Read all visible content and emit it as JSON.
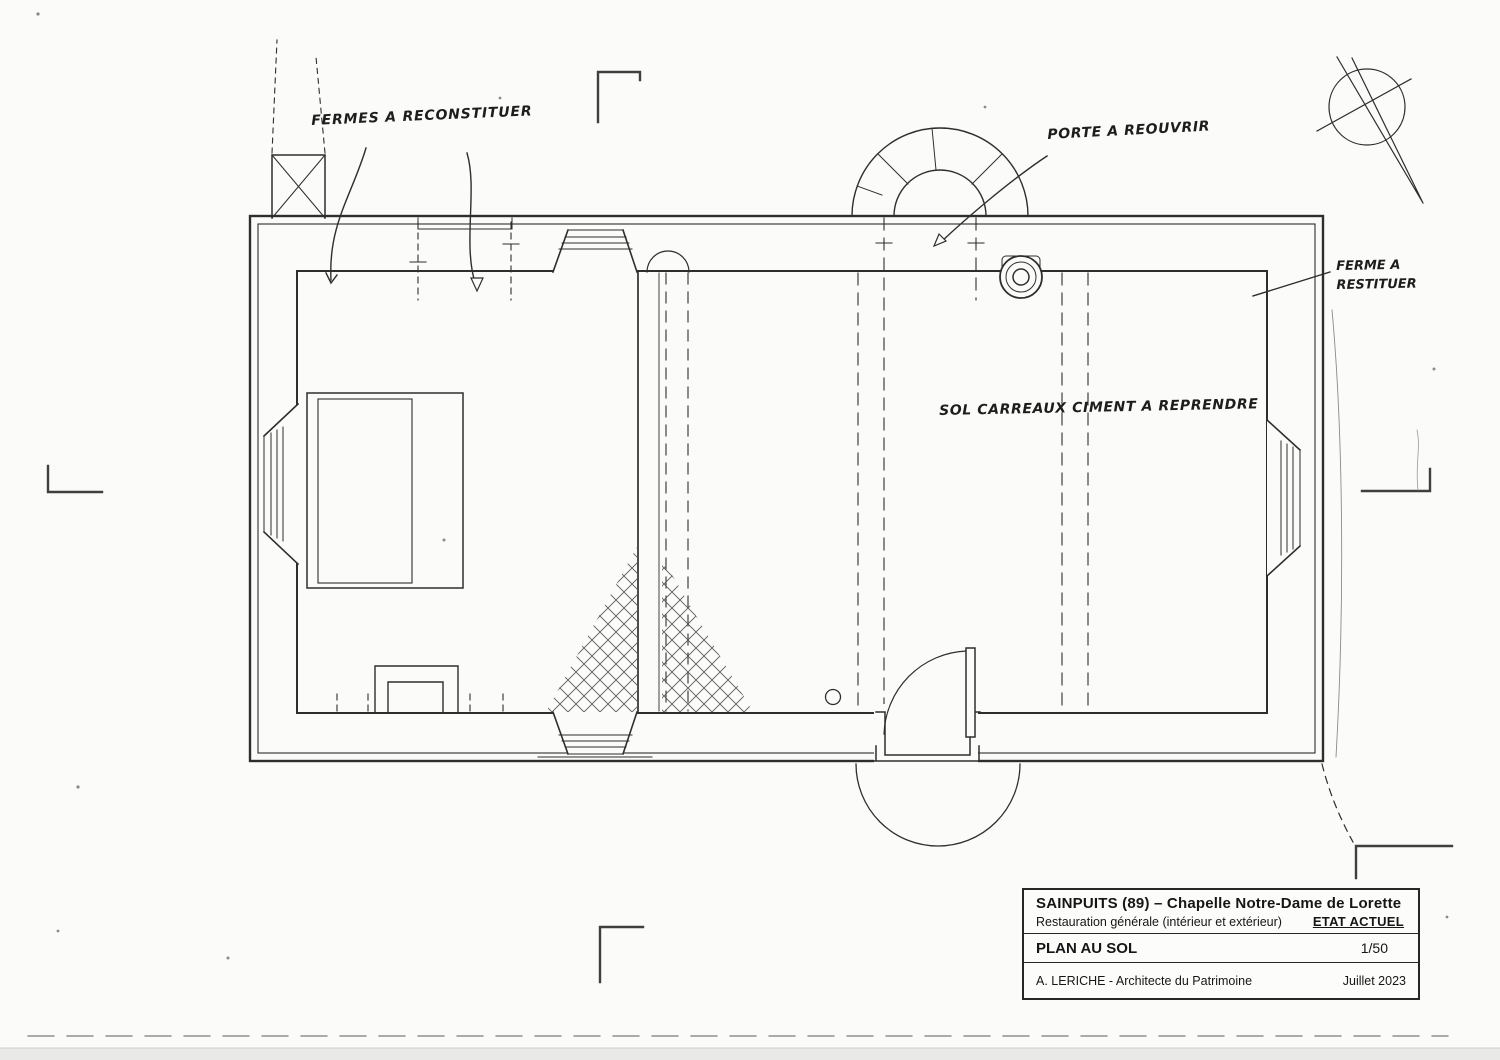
{
  "annotations": {
    "trusses_note": "FERMES A RECONSTITUER",
    "door_note": "PORTE A REOUVRIR",
    "truss_single_note_line1": "FERME A",
    "truss_single_note_line2": "RESTITUER",
    "floor_note": "SOL CARREAUX CIMENT A REPRENDRE"
  },
  "title_block": {
    "project": "SAINPUITS (89) – Chapelle Notre-Dame de Lorette",
    "subtitle": "Restauration générale (intérieur et extérieur)",
    "status": "ETAT ACTUEL",
    "drawing_title": "PLAN AU SOL",
    "scale": "1/50",
    "author": "A. LERICHE - Architecte du Patrimoine",
    "date": "Juillet 2023"
  },
  "colors": {
    "ink": "#2e2e2e",
    "paper": "#fbfbf9"
  }
}
